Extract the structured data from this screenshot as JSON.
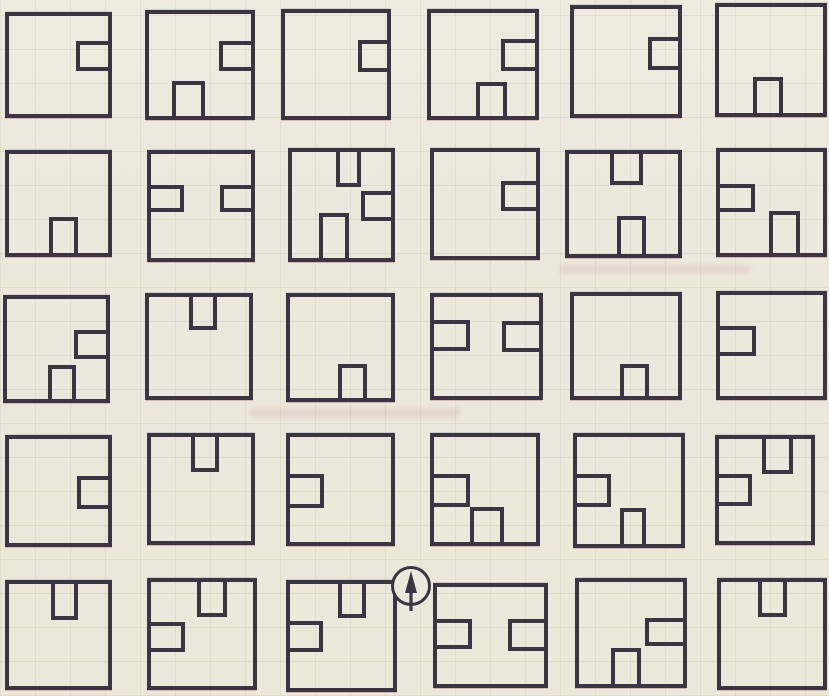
{
  "page": {
    "kind": "scanned worksheet page with a 5x6 grid of square figures",
    "background_color": "#ece8db",
    "line_color": "#3e3345"
  },
  "marker": {
    "icon": "up-arrow-in-circle-icon",
    "cx": 411,
    "cy": 586,
    "r": 20
  },
  "grid": {
    "rows": 5,
    "cols": 6,
    "cells": [
      {
        "row": 0,
        "col": 0,
        "x": 5,
        "y": 12,
        "w": 107,
        "h": 106,
        "inners": [
          {
            "edge": "right",
            "pos": 25,
            "w": 32,
            "h": 31
          }
        ]
      },
      {
        "row": 0,
        "col": 1,
        "x": 145,
        "y": 10,
        "w": 110,
        "h": 110,
        "inners": [
          {
            "edge": "right",
            "pos": 26,
            "w": 31,
            "h": 30
          },
          {
            "edge": "bottom",
            "pos": 23,
            "w": 32,
            "h": 34
          }
        ]
      },
      {
        "row": 0,
        "col": 2,
        "x": 281,
        "y": 9,
        "w": 110,
        "h": 111,
        "inners": [
          {
            "edge": "right",
            "pos": 26,
            "w": 28,
            "h": 31
          }
        ]
      },
      {
        "row": 0,
        "col": 3,
        "x": 427,
        "y": 9,
        "w": 112,
        "h": 111,
        "inners": [
          {
            "edge": "right",
            "pos": 25,
            "w": 33,
            "h": 31
          },
          {
            "edge": "bottom",
            "pos": 43,
            "w": 30,
            "h": 33
          }
        ]
      },
      {
        "row": 0,
        "col": 4,
        "x": 570,
        "y": 5,
        "w": 112,
        "h": 113,
        "inners": [
          {
            "edge": "right",
            "pos": 27,
            "w": 29,
            "h": 31
          }
        ]
      },
      {
        "row": 0,
        "col": 5,
        "x": 715,
        "y": 3,
        "w": 112,
        "h": 114,
        "inners": [
          {
            "edge": "bottom",
            "pos": 33,
            "w": 29,
            "h": 34
          }
        ]
      },
      {
        "row": 1,
        "col": 0,
        "x": 5,
        "y": 150,
        "w": 107,
        "h": 107,
        "inners": [
          {
            "edge": "bottom",
            "pos": 40,
            "w": 30,
            "h": 36
          }
        ]
      },
      {
        "row": 1,
        "col": 1,
        "x": 147,
        "y": 150,
        "w": 108,
        "h": 112,
        "inners": [
          {
            "edge": "left",
            "pos": 30,
            "w": 33,
            "h": 26
          },
          {
            "edge": "right",
            "pos": 30,
            "w": 31,
            "h": 26
          }
        ]
      },
      {
        "row": 1,
        "col": 2,
        "x": 288,
        "y": 148,
        "w": 107,
        "h": 114,
        "inners": [
          {
            "edge": "top",
            "pos": 44,
            "w": 26,
            "h": 33
          },
          {
            "edge": "right",
            "pos": 37,
            "w": 30,
            "h": 28
          },
          {
            "edge": "bottom",
            "pos": 27,
            "w": 31,
            "h": 42
          }
        ]
      },
      {
        "row": 1,
        "col": 3,
        "x": 430,
        "y": 148,
        "w": 110,
        "h": 112,
        "inners": [
          {
            "edge": "right",
            "pos": 28,
            "w": 34,
            "h": 29
          }
        ]
      },
      {
        "row": 1,
        "col": 4,
        "x": 565,
        "y": 150,
        "w": 117,
        "h": 108,
        "inners": [
          {
            "edge": "top",
            "pos": 38,
            "w": 30,
            "h": 31
          },
          {
            "edge": "bottom",
            "pos": 44,
            "w": 27,
            "h": 38
          }
        ]
      },
      {
        "row": 1,
        "col": 5,
        "x": 716,
        "y": 148,
        "w": 111,
        "h": 109,
        "inners": [
          {
            "edge": "left",
            "pos": 32,
            "w": 34,
            "h": 27
          },
          {
            "edge": "bottom",
            "pos": 48,
            "w": 30,
            "h": 42
          }
        ]
      },
      {
        "row": 2,
        "col": 0,
        "x": 3,
        "y": 295,
        "w": 107,
        "h": 108,
        "inners": [
          {
            "edge": "right",
            "pos": 31,
            "w": 32,
            "h": 29
          },
          {
            "edge": "bottom",
            "pos": 41,
            "w": 29,
            "h": 34
          }
        ]
      },
      {
        "row": 2,
        "col": 1,
        "x": 145,
        "y": 293,
        "w": 108,
        "h": 107,
        "inners": [
          {
            "edge": "top",
            "pos": 40,
            "w": 28,
            "h": 33
          }
        ]
      },
      {
        "row": 2,
        "col": 2,
        "x": 286,
        "y": 293,
        "w": 109,
        "h": 109,
        "inners": [
          {
            "edge": "bottom",
            "pos": 48,
            "w": 28,
            "h": 34
          }
        ]
      },
      {
        "row": 2,
        "col": 3,
        "x": 430,
        "y": 293,
        "w": 113,
        "h": 107,
        "inners": [
          {
            "edge": "left",
            "pos": 23,
            "w": 34,
            "h": 32
          },
          {
            "edge": "right",
            "pos": 24,
            "w": 35,
            "h": 32
          }
        ]
      },
      {
        "row": 2,
        "col": 4,
        "x": 570,
        "y": 292,
        "w": 112,
        "h": 108,
        "inners": [
          {
            "edge": "bottom",
            "pos": 44,
            "w": 28,
            "h": 32
          }
        ]
      },
      {
        "row": 2,
        "col": 5,
        "x": 716,
        "y": 291,
        "w": 111,
        "h": 109,
        "inners": [
          {
            "edge": "left",
            "pos": 31,
            "w": 35,
            "h": 29
          }
        ]
      },
      {
        "row": 3,
        "col": 0,
        "x": 5,
        "y": 435,
        "w": 107,
        "h": 112,
        "inners": [
          {
            "edge": "right",
            "pos": 36,
            "w": 31,
            "h": 31
          }
        ]
      },
      {
        "row": 3,
        "col": 1,
        "x": 147,
        "y": 433,
        "w": 108,
        "h": 112,
        "inners": [
          {
            "edge": "top",
            "pos": 40,
            "w": 28,
            "h": 34
          }
        ]
      },
      {
        "row": 3,
        "col": 2,
        "x": 286,
        "y": 433,
        "w": 109,
        "h": 113,
        "inners": [
          {
            "edge": "left",
            "pos": 35,
            "w": 34,
            "h": 33
          }
        ]
      },
      {
        "row": 3,
        "col": 3,
        "x": 430,
        "y": 433,
        "w": 110,
        "h": 113,
        "inners": [
          {
            "edge": "left",
            "pos": 35,
            "w": 35,
            "h": 32
          },
          {
            "edge": "bottom",
            "pos": 35,
            "w": 34,
            "h": 33
          }
        ]
      },
      {
        "row": 3,
        "col": 4,
        "x": 573,
        "y": 433,
        "w": 112,
        "h": 115,
        "inners": [
          {
            "edge": "left",
            "pos": 35,
            "w": 33,
            "h": 30
          },
          {
            "edge": "bottom",
            "pos": 41,
            "w": 25,
            "h": 34
          }
        ]
      },
      {
        "row": 3,
        "col": 5,
        "x": 715,
        "y": 435,
        "w": 100,
        "h": 110,
        "inners": [
          {
            "edge": "top",
            "pos": 47,
            "w": 33,
            "h": 34
          },
          {
            "edge": "left",
            "pos": 34,
            "w": 36,
            "h": 32
          }
        ]
      },
      {
        "row": 4,
        "col": 0,
        "x": 5,
        "y": 580,
        "w": 107,
        "h": 110,
        "inners": [
          {
            "edge": "top",
            "pos": 42,
            "w": 28,
            "h": 35
          }
        ]
      },
      {
        "row": 4,
        "col": 1,
        "x": 147,
        "y": 578,
        "w": 110,
        "h": 112,
        "inners": [
          {
            "edge": "top",
            "pos": 45,
            "w": 30,
            "h": 34
          },
          {
            "edge": "left",
            "pos": 38,
            "w": 33,
            "h": 29
          }
        ]
      },
      {
        "row": 4,
        "col": 2,
        "x": 286,
        "y": 580,
        "w": 111,
        "h": 112,
        "inners": [
          {
            "edge": "top",
            "pos": 47,
            "w": 27,
            "h": 33
          },
          {
            "edge": "left",
            "pos": 36,
            "w": 32,
            "h": 29
          }
        ]
      },
      {
        "row": 4,
        "col": 3,
        "x": 433,
        "y": 583,
        "w": 115,
        "h": 105,
        "inners": [
          {
            "edge": "left",
            "pos": 33,
            "w": 33,
            "h": 31
          },
          {
            "edge": "right",
            "pos": 33,
            "w": 34,
            "h": 33
          }
        ]
      },
      {
        "row": 4,
        "col": 4,
        "x": 575,
        "y": 578,
        "w": 112,
        "h": 110,
        "inners": [
          {
            "edge": "right",
            "pos": 35,
            "w": 37,
            "h": 28
          },
          {
            "edge": "bottom",
            "pos": 31,
            "w": 29,
            "h": 35
          }
        ]
      },
      {
        "row": 4,
        "col": 5,
        "x": 717,
        "y": 578,
        "w": 110,
        "h": 112,
        "inners": [
          {
            "edge": "top",
            "pos": 36,
            "w": 29,
            "h": 34
          }
        ]
      }
    ]
  }
}
